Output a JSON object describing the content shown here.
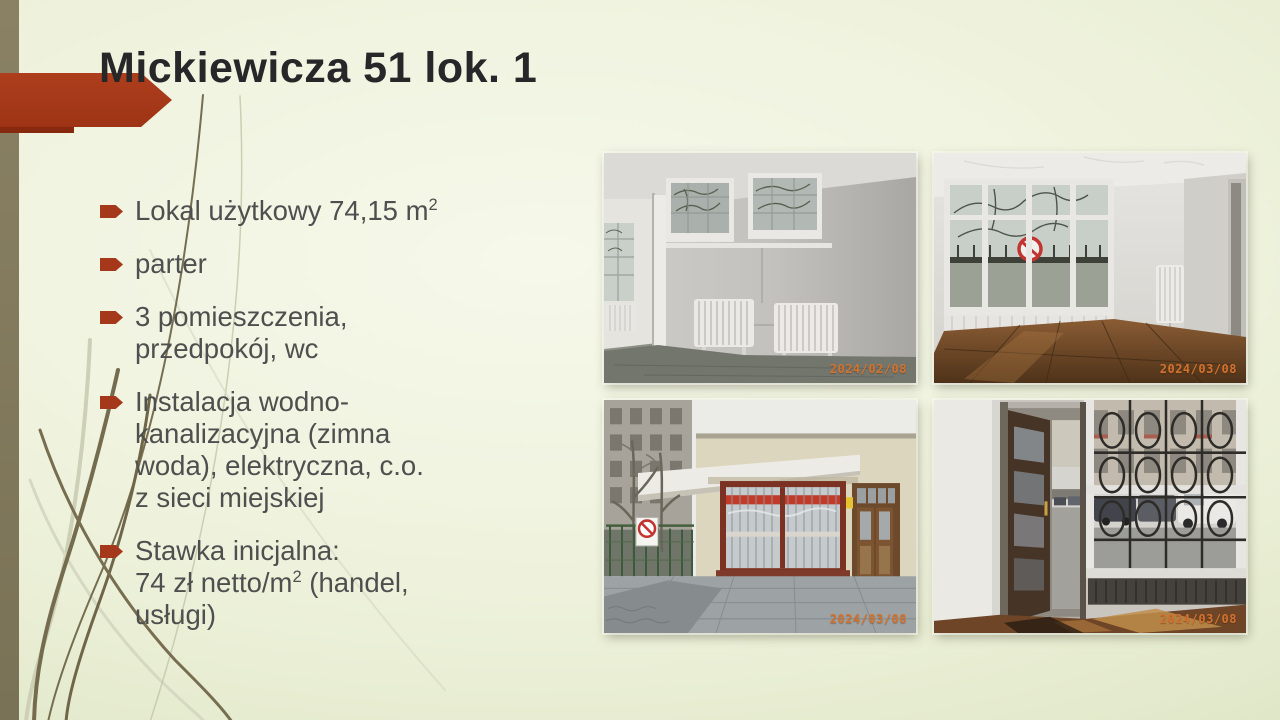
{
  "slide": {
    "title": "Mickiewicza 51 lok. 1",
    "bullets": [
      {
        "lines": [
          [
            {
              "t": "Lokal użytkowy 74,15 m"
            },
            {
              "t": "2",
              "sup": true
            }
          ]
        ]
      },
      {
        "lines": [
          [
            {
              "t": "parter"
            }
          ]
        ]
      },
      {
        "lines": [
          [
            {
              "t": "3 pomieszczenia,"
            }
          ],
          [
            {
              "t": "przedpokój, wc"
            }
          ]
        ]
      },
      {
        "lines": [
          [
            {
              "t": "Instalacja wodno-"
            }
          ],
          [
            {
              "t": "kanalizacyjna (zimna"
            }
          ],
          [
            {
              "t": "woda), elektryczna, c.o."
            }
          ],
          [
            {
              "t": "z sieci miejskiej"
            }
          ]
        ]
      },
      {
        "lines": [
          [
            {
              "t": "Stawka inicjalna:"
            }
          ],
          [
            {
              "t": "74 zł netto/m"
            },
            {
              "t": "2",
              "sup": true
            },
            {
              "t": " (handel,"
            }
          ],
          [
            {
              "t": "usługi)"
            }
          ]
        ]
      }
    ],
    "photos": [
      {
        "id": "interior-room-with-radiators",
        "timestamp": "2024/02/08"
      },
      {
        "id": "interior-corner-window-parquet",
        "timestamp": "2024/03/08"
      },
      {
        "id": "exterior-storefront-pavilion",
        "timestamp": "2024/03/08"
      },
      {
        "id": "entrance-hall-window-grille",
        "timestamp": "2024/03/08"
      }
    ],
    "colors": {
      "accent_red": "#a93b1b",
      "edge_bar_olive": "#837a5c",
      "title_text": "#262628",
      "body_text": "#4f4f4f",
      "timestamp_orange": "#d2722f",
      "background": "#eef2dc"
    }
  }
}
